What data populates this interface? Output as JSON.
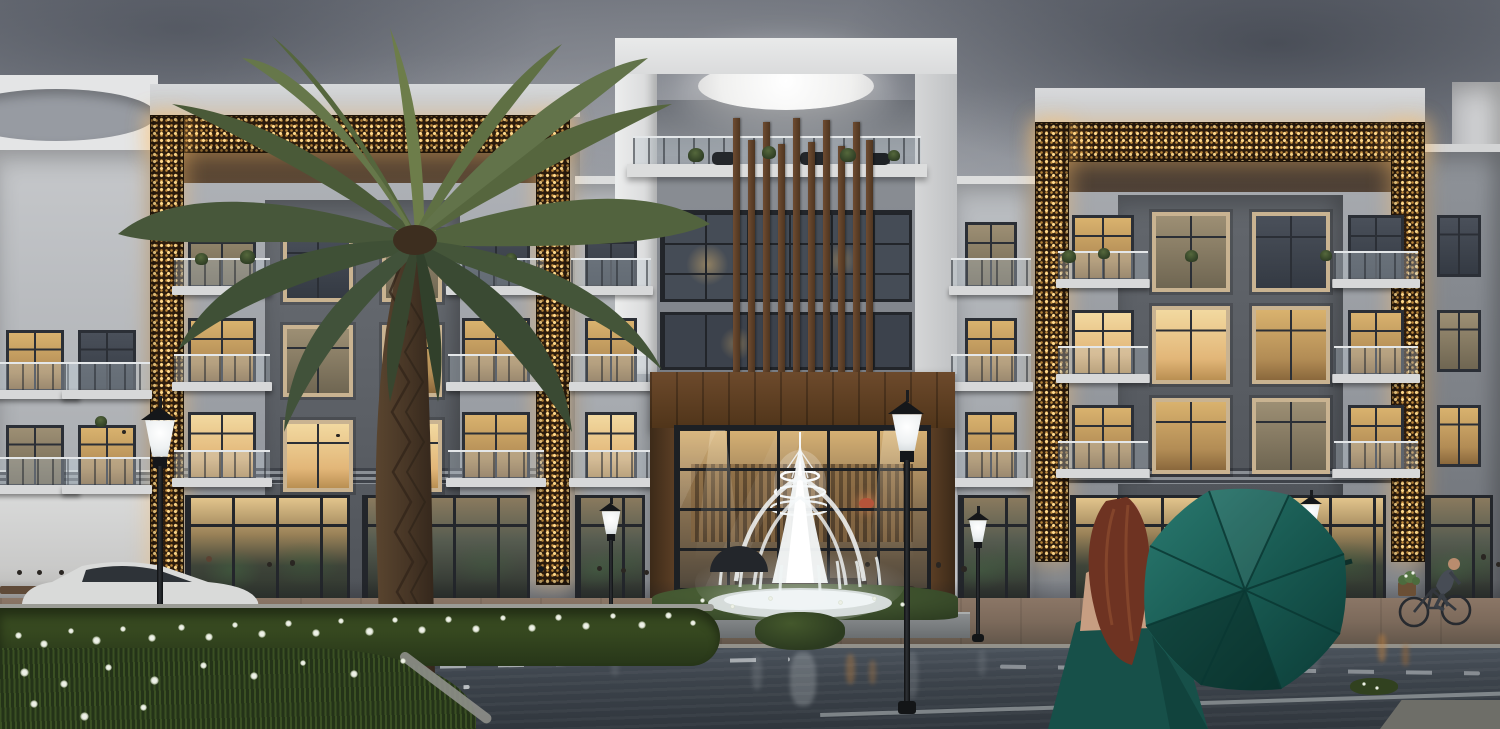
{
  "meta": {
    "title": "Dusk architectural rendering - luxury low-rise residential complex with golden mashrabiya frames, entrance fountain, palm tree and woman holding a teal umbrella",
    "canvas": {
      "w": 1500,
      "h": 729
    }
  },
  "colors": {
    "skyTop": "#6d717a",
    "skyMid": "#979ba2",
    "skyLow": "#bfc1c4",
    "cloudDark": "#4e545e",
    "cloudLight": "#d6d7d9",
    "facadeWhite": "#e4e5e6",
    "facadeLight": "#b6b9bd",
    "facadeMid": "#9a9ea4",
    "facadeGray": "#7d8187",
    "facadeDark": "#60646a",
    "blockDark": "#54585e",
    "roofSoffit": "#463526",
    "goldBase": "#2e1d0e",
    "goldBright": "#ffd98c",
    "goldMid": "#c08b3e",
    "goldGlow": "rgba(255,193,106,0.40)",
    "woodDark": "#4a3220",
    "woodMid": "#6b4a2e",
    "woodLight": "#8a6540",
    "slat": "#6f4c31",
    "winBright": "#f2d9a0",
    "winWarm": "#d9b26e",
    "winDark": "#343a43",
    "winFrame": "#2b2f36",
    "beigeFrame": "#c9b391",
    "railGlass": "rgba(190,200,208,0.35)",
    "slabWhite": "#d7d8d9",
    "mullion": "#23262b",
    "lobbyGlowTop": "#d8b274",
    "sidewalk": "#7c6a5b",
    "curb": "#9b9b95",
    "road": "#3c434b",
    "roadFar": "#4a525b",
    "laneWhite": "#cfd3d6",
    "grassDark": "#243318",
    "grassMid": "#35471f",
    "shrub": "#3c4f2c",
    "flowerWhite": "#eef1e8",
    "fountainWhite": "#f4f8f9",
    "lampBlack": "#1b1d20",
    "lampGlow": "#ffffff",
    "carBody": "#d9dad9",
    "tire": "#24262a",
    "umbrellaLight": "#2a7a70",
    "umbrella": "#17574f",
    "umbrellaDark": "#0b3b36",
    "dressTeal": "#175049",
    "hair": "#6e3322",
    "hairLight": "#8a4a2e",
    "skin": "#d4a488",
    "silhouette": "#2e3238",
    "orangeReflect": "#c9853f"
  },
  "scene": {
    "windows": [
      {
        "x": 6,
        "y": 330,
        "w": 58,
        "h": 62,
        "kind": "balcony",
        "lit": "warm"
      },
      {
        "x": 78,
        "y": 330,
        "w": 58,
        "h": 62,
        "kind": "balcony",
        "lit": "dark"
      },
      {
        "x": 6,
        "y": 425,
        "w": 58,
        "h": 62,
        "kind": "balcony",
        "lit": "dim"
      },
      {
        "x": 78,
        "y": 425,
        "w": 58,
        "h": 62,
        "kind": "balcony",
        "lit": "warm"
      },
      {
        "x": 188,
        "y": 222,
        "w": 68,
        "h": 66,
        "kind": "balcony",
        "lit": "dim"
      },
      {
        "x": 188,
        "y": 318,
        "w": 68,
        "h": 66,
        "kind": "balcony",
        "lit": "warm"
      },
      {
        "x": 188,
        "y": 412,
        "w": 68,
        "h": 68,
        "kind": "balcony",
        "lit": "bright"
      },
      {
        "x": 462,
        "y": 222,
        "w": 68,
        "h": 66,
        "kind": "balcony",
        "lit": "dark"
      },
      {
        "x": 462,
        "y": 318,
        "w": 68,
        "h": 66,
        "kind": "balcony",
        "lit": "warm"
      },
      {
        "x": 462,
        "y": 412,
        "w": 68,
        "h": 68,
        "kind": "balcony",
        "lit": "warm"
      },
      {
        "x": 283,
        "y": 230,
        "w": 70,
        "h": 72,
        "kind": "beige",
        "lit": "dark"
      },
      {
        "x": 382,
        "y": 230,
        "w": 60,
        "h": 72,
        "kind": "beige",
        "lit": "dim"
      },
      {
        "x": 283,
        "y": 325,
        "w": 70,
        "h": 72,
        "kind": "beige",
        "lit": "dim"
      },
      {
        "x": 382,
        "y": 325,
        "w": 60,
        "h": 72,
        "kind": "beige",
        "lit": "warm"
      },
      {
        "x": 283,
        "y": 420,
        "w": 70,
        "h": 72,
        "kind": "beige",
        "lit": "bright"
      },
      {
        "x": 382,
        "y": 420,
        "w": 60,
        "h": 72,
        "kind": "beige",
        "lit": "bright"
      },
      {
        "x": 585,
        "y": 222,
        "w": 52,
        "h": 66,
        "kind": "balcony",
        "lit": "dark"
      },
      {
        "x": 585,
        "y": 318,
        "w": 52,
        "h": 66,
        "kind": "balcony",
        "lit": "warm"
      },
      {
        "x": 585,
        "y": 412,
        "w": 52,
        "h": 68,
        "kind": "balcony",
        "lit": "bright"
      },
      {
        "x": 965,
        "y": 222,
        "w": 52,
        "h": 66,
        "kind": "balcony",
        "lit": "dim"
      },
      {
        "x": 965,
        "y": 318,
        "w": 52,
        "h": 66,
        "kind": "balcony",
        "lit": "warm"
      },
      {
        "x": 965,
        "y": 412,
        "w": 52,
        "h": 68,
        "kind": "balcony",
        "lit": "warm"
      },
      {
        "x": 1072,
        "y": 215,
        "w": 62,
        "h": 66,
        "kind": "balcony",
        "lit": "warm"
      },
      {
        "x": 1072,
        "y": 310,
        "w": 62,
        "h": 66,
        "kind": "balcony",
        "lit": "bright"
      },
      {
        "x": 1072,
        "y": 405,
        "w": 62,
        "h": 66,
        "kind": "balcony",
        "lit": "warm"
      },
      {
        "x": 1348,
        "y": 215,
        "w": 56,
        "h": 66,
        "kind": "balcony",
        "lit": "dark"
      },
      {
        "x": 1348,
        "y": 310,
        "w": 56,
        "h": 66,
        "kind": "balcony",
        "lit": "warm"
      },
      {
        "x": 1348,
        "y": 405,
        "w": 56,
        "h": 66,
        "kind": "balcony",
        "lit": "warm"
      },
      {
        "x": 1152,
        "y": 212,
        "w": 78,
        "h": 80,
        "kind": "beige",
        "lit": "dim"
      },
      {
        "x": 1252,
        "y": 212,
        "w": 78,
        "h": 80,
        "kind": "beige",
        "lit": "dark"
      },
      {
        "x": 1152,
        "y": 306,
        "w": 78,
        "h": 78,
        "kind": "beige",
        "lit": "bright"
      },
      {
        "x": 1252,
        "y": 306,
        "w": 78,
        "h": 78,
        "kind": "beige",
        "lit": "warm"
      },
      {
        "x": 1152,
        "y": 398,
        "w": 78,
        "h": 76,
        "kind": "beige",
        "lit": "warm"
      },
      {
        "x": 1252,
        "y": 398,
        "w": 78,
        "h": 76,
        "kind": "beige",
        "lit": "dim"
      },
      {
        "x": 1437,
        "y": 215,
        "w": 44,
        "h": 62,
        "kind": "plain",
        "lit": "dark"
      },
      {
        "x": 1437,
        "y": 310,
        "w": 44,
        "h": 62,
        "kind": "plain",
        "lit": "dim"
      },
      {
        "x": 1437,
        "y": 405,
        "w": 44,
        "h": 62,
        "kind": "plain",
        "lit": "warm"
      }
    ],
    "storefrontRow": {
      "y": 495,
      "h": 112
    },
    "storefronts": [
      {
        "x": 185,
        "w": 165,
        "tone": "bright"
      },
      {
        "x": 362,
        "w": 168,
        "tone": "dim"
      },
      {
        "x": 575,
        "w": 70,
        "tone": "dim"
      },
      {
        "x": 958,
        "w": 72,
        "tone": "dim"
      },
      {
        "x": 1070,
        "w": 152,
        "tone": "bright"
      },
      {
        "x": 1238,
        "w": 148,
        "tone": "bright"
      },
      {
        "x": 1425,
        "w": 68,
        "tone": "dim"
      }
    ],
    "slats": {
      "bottom": 372,
      "bars": [
        {
          "x": 733,
          "y": 118
        },
        {
          "x": 748,
          "y": 140
        },
        {
          "x": 763,
          "y": 122
        },
        {
          "x": 778,
          "y": 144
        },
        {
          "x": 793,
          "y": 118
        },
        {
          "x": 808,
          "y": 142
        },
        {
          "x": 823,
          "y": 120
        },
        {
          "x": 838,
          "y": 146
        },
        {
          "x": 853,
          "y": 122
        },
        {
          "x": 866,
          "y": 140
        }
      ]
    },
    "lamps": [
      {
        "x": 160,
        "top": 396,
        "ground": 729,
        "s": 1.35
      },
      {
        "x": 611,
        "top": 496,
        "ground": 644,
        "s": 0.85
      },
      {
        "x": 907,
        "top": 390,
        "ground": 714,
        "s": 1.35
      },
      {
        "x": 978,
        "top": 506,
        "ground": 642,
        "s": 0.8
      },
      {
        "x": 1311,
        "top": 490,
        "ground": 630,
        "s": 0.8
      }
    ],
    "people": [
      {
        "x": 12,
        "y": 622,
        "h": 52,
        "c": "#2f333a",
        "t": "p"
      },
      {
        "x": 32,
        "y": 620,
        "h": 50,
        "c": "#3c424c",
        "t": "p"
      },
      {
        "x": 54,
        "y": 618,
        "h": 48,
        "c": "#4a4f58",
        "t": "p"
      },
      {
        "x": 96,
        "y": 620,
        "h": 54,
        "c": "#e4e2de",
        "t": "p"
      },
      {
        "x": 118,
        "y": 618,
        "h": 50,
        "c": "#333842",
        "t": "p"
      },
      {
        "x": 200,
        "y": 614,
        "h": 58,
        "c": "#eceae4",
        "t": "kandura"
      },
      {
        "x": 262,
        "y": 612,
        "h": 50,
        "c": "#3a3f48",
        "t": "p"
      },
      {
        "x": 284,
        "y": 616,
        "h": 56,
        "c": "#8e949c",
        "t": "p"
      },
      {
        "x": 532,
        "y": 624,
        "h": 58,
        "c": "#101214",
        "t": "abaya"
      },
      {
        "x": 556,
        "y": 626,
        "h": 60,
        "c": "#0c0e10",
        "t": "abaya"
      },
      {
        "x": 592,
        "y": 616,
        "h": 50,
        "c": "#454a54",
        "t": "p"
      },
      {
        "x": 616,
        "y": 620,
        "h": 52,
        "c": "#2c3038",
        "t": "p"
      },
      {
        "x": 639,
        "y": 618,
        "h": 48,
        "c": "#50555e",
        "t": "p"
      },
      {
        "x": 724,
        "y": 614,
        "h": 52,
        "c": "#23262c",
        "t": "p"
      },
      {
        "x": 744,
        "y": 614,
        "h": 54,
        "c": "#2b2f36",
        "t": "p"
      },
      {
        "x": 860,
        "y": 612,
        "h": 50,
        "c": "#3f444d",
        "t": "p"
      },
      {
        "x": 930,
        "y": 618,
        "h": 56,
        "c": "#2f333b",
        "t": "p"
      },
      {
        "x": 956,
        "y": 620,
        "h": 54,
        "c": "#3d5a82",
        "t": "p"
      },
      {
        "x": 1268,
        "y": 612,
        "h": 52,
        "c": "#b3903f",
        "t": "p"
      },
      {
        "x": 1291,
        "y": 614,
        "h": 54,
        "c": "#8b9099",
        "t": "p"
      },
      {
        "x": 1322,
        "y": 612,
        "h": 52,
        "c": "#2d3138",
        "t": "p"
      },
      {
        "x": 1475,
        "y": 610,
        "h": 56,
        "c": "#30343c",
        "t": "p"
      },
      {
        "x": 1491,
        "y": 612,
        "h": 50,
        "c": "#3b414b",
        "t": "p"
      },
      {
        "x": 118,
        "y": 470,
        "h": 40,
        "c": "#1c1f24",
        "t": "p"
      },
      {
        "x": 333,
        "y": 468,
        "h": 34,
        "c": "#2a2e35",
        "t": "p"
      },
      {
        "x": 560,
        "y": 468,
        "h": 36,
        "c": "#3e3b36",
        "t": "p"
      }
    ],
    "flowers": [
      [
        15,
        632,
        7
      ],
      [
        40,
        640,
        8
      ],
      [
        68,
        628,
        6
      ],
      [
        92,
        636,
        9
      ],
      [
        120,
        626,
        6
      ],
      [
        148,
        634,
        8
      ],
      [
        178,
        624,
        7
      ],
      [
        205,
        633,
        8
      ],
      [
        232,
        622,
        6
      ],
      [
        258,
        630,
        8
      ],
      [
        285,
        620,
        7
      ],
      [
        312,
        629,
        8
      ],
      [
        338,
        618,
        6
      ],
      [
        365,
        627,
        9
      ],
      [
        392,
        617,
        6
      ],
      [
        418,
        626,
        8
      ],
      [
        445,
        616,
        7
      ],
      [
        472,
        625,
        8
      ],
      [
        500,
        615,
        6
      ],
      [
        528,
        624,
        8
      ],
      [
        555,
        614,
        7
      ],
      [
        582,
        622,
        8
      ],
      [
        610,
        613,
        6
      ],
      [
        638,
        621,
        8
      ],
      [
        665,
        612,
        7
      ],
      [
        690,
        620,
        6
      ],
      [
        20,
        668,
        9
      ],
      [
        60,
        680,
        8
      ],
      [
        105,
        664,
        7
      ],
      [
        150,
        676,
        9
      ],
      [
        200,
        662,
        7
      ],
      [
        250,
        672,
        8
      ],
      [
        300,
        660,
        6
      ],
      [
        350,
        670,
        8
      ],
      [
        400,
        658,
        6
      ],
      [
        30,
        700,
        8
      ],
      [
        80,
        712,
        9
      ],
      [
        140,
        704,
        7
      ],
      [
        700,
        598,
        5
      ],
      [
        730,
        604,
        5
      ],
      [
        768,
        596,
        5
      ],
      [
        838,
        600,
        5
      ],
      [
        872,
        596,
        5
      ],
      [
        900,
        602,
        5
      ],
      [
        1362,
        682,
        4
      ],
      [
        1375,
        686,
        4
      ]
    ],
    "planters": [
      {
        "x": 688,
        "y": 148,
        "s": 16
      },
      {
        "x": 762,
        "y": 146,
        "s": 14
      },
      {
        "x": 840,
        "y": 148,
        "s": 16
      },
      {
        "x": 888,
        "y": 150,
        "s": 12
      },
      {
        "x": 1062,
        "y": 250,
        "s": 14
      },
      {
        "x": 1098,
        "y": 248,
        "s": 12
      },
      {
        "x": 1185,
        "y": 250,
        "s": 13
      },
      {
        "x": 1320,
        "y": 250,
        "s": 12
      },
      {
        "x": 195,
        "y": 253,
        "s": 13
      },
      {
        "x": 240,
        "y": 250,
        "s": 15
      },
      {
        "x": 505,
        "y": 253,
        "s": 12
      },
      {
        "x": 95,
        "y": 416,
        "s": 12
      }
    ],
    "reflections": [
      {
        "x": 790,
        "y": 652,
        "w": 26,
        "h": 54,
        "c": "#e9eef0",
        "o": 0.22
      },
      {
        "x": 752,
        "y": 656,
        "w": 10,
        "h": 34,
        "c": "#e9eef0",
        "o": 0.12
      },
      {
        "x": 846,
        "y": 654,
        "w": 9,
        "h": 30,
        "c": "#c9853f",
        "o": 0.35
      },
      {
        "x": 869,
        "y": 660,
        "w": 7,
        "h": 24,
        "c": "#c9853f",
        "o": 0.3
      },
      {
        "x": 1378,
        "y": 634,
        "w": 8,
        "h": 28,
        "c": "#c9853f",
        "o": 0.45
      },
      {
        "x": 1402,
        "y": 644,
        "w": 7,
        "h": 22,
        "c": "#b3702f",
        "o": 0.4
      },
      {
        "x": 160,
        "y": 652,
        "w": 12,
        "h": 40,
        "c": "#dde1e3",
        "o": 0.12
      },
      {
        "x": 906,
        "y": 652,
        "w": 12,
        "h": 46,
        "c": "#dde1e3",
        "o": 0.14
      },
      {
        "x": 611,
        "y": 650,
        "w": 8,
        "h": 26,
        "c": "#dde1e3",
        "o": 0.1
      },
      {
        "x": 978,
        "y": 650,
        "w": 8,
        "h": 26,
        "c": "#dde1e3",
        "o": 0.1
      },
      {
        "x": 1311,
        "y": 648,
        "w": 8,
        "h": 24,
        "c": "#dde1e3",
        "o": 0.1
      }
    ]
  }
}
